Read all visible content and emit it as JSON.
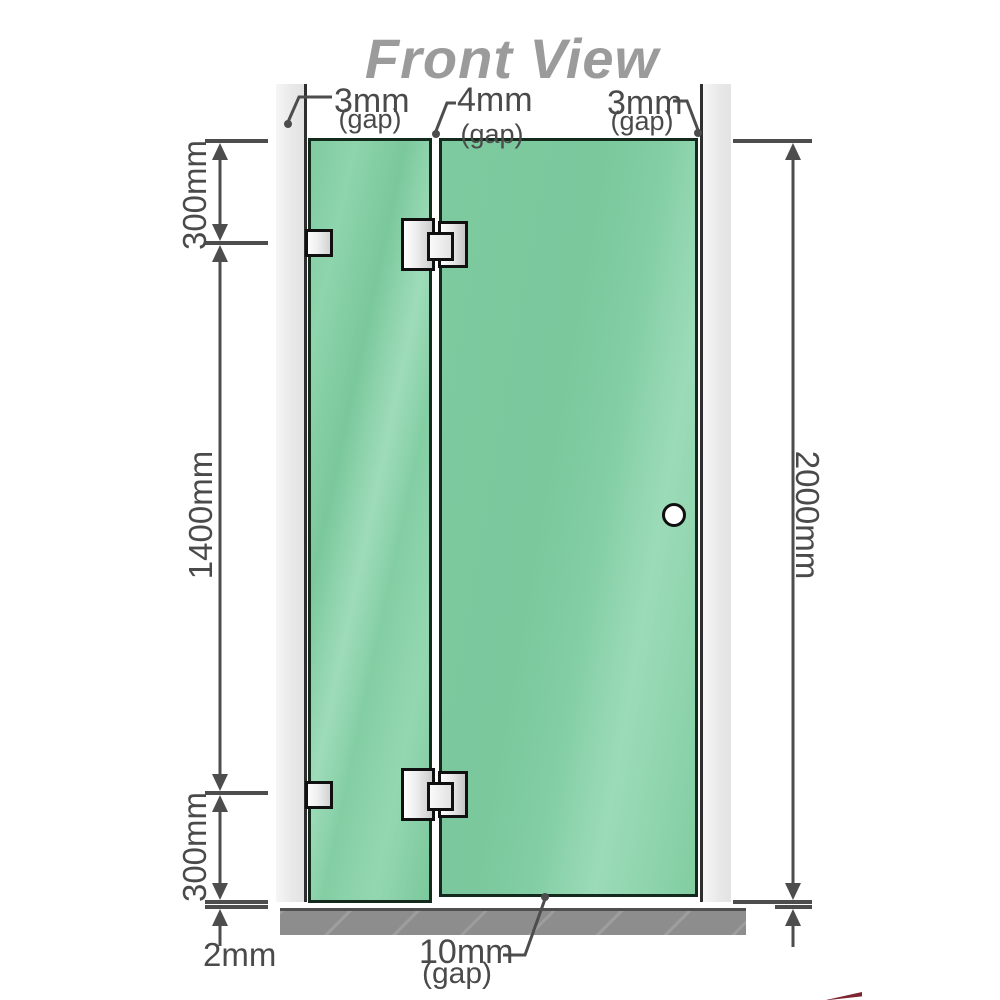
{
  "title": "Front View",
  "gaps": {
    "left": {
      "value": "3mm",
      "note": "(gap)"
    },
    "middle": {
      "value": "4mm",
      "note": "(gap)"
    },
    "right": {
      "value": "3mm",
      "note": "(gap)"
    },
    "bottom": {
      "value": "10mm",
      "note": "(gap)"
    }
  },
  "dimensions": {
    "top_section": "300mm",
    "middle_section": "1400mm",
    "bottom_section": "300mm",
    "total_height": "2000mm",
    "floor_gap": "2mm"
  },
  "colors": {
    "glass_green": "#84cfa5",
    "wall_gray": "#ececec",
    "floor_gray": "#8d8d8d",
    "line_gray": "#4d4d4d",
    "title_gray": "#9b9b9b",
    "hardware_black": "#101010"
  }
}
